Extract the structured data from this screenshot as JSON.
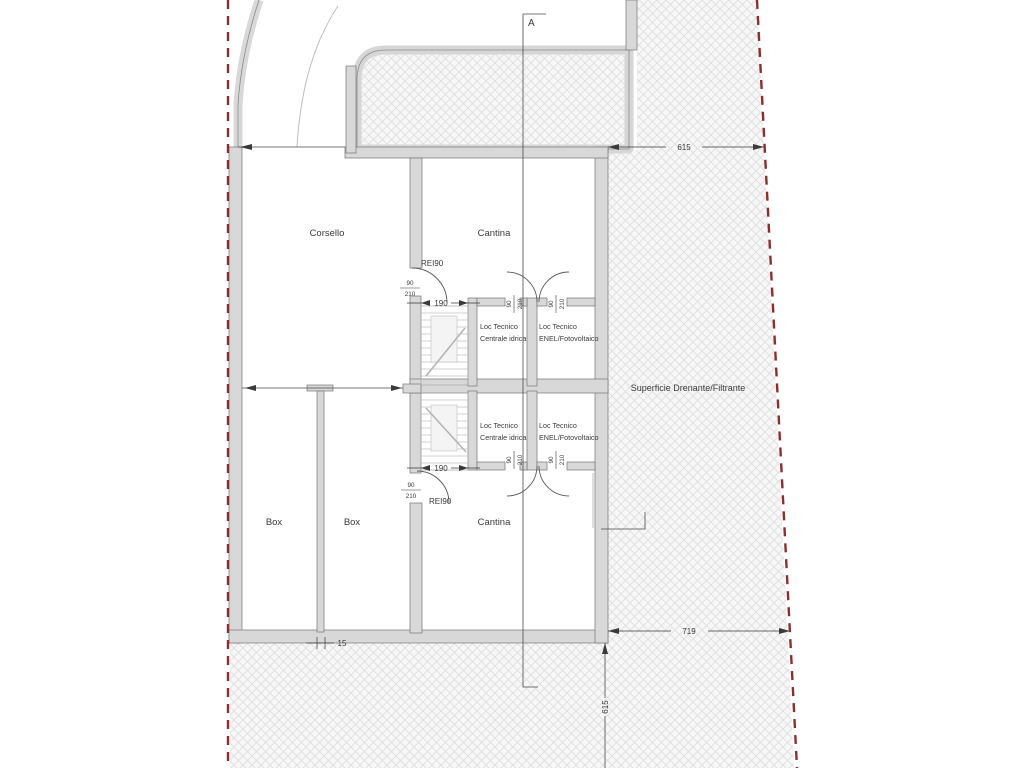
{
  "drawing": {
    "title_hint": "basement floor plan",
    "section_label": "A",
    "site_label": "Superficie Drenante/Filtrante",
    "rooms": {
      "corsello": "Corsello",
      "cantina_top": "Cantina",
      "cantina_bottom": "Cantina",
      "box_left": "Box",
      "box_right": "Box"
    },
    "tech": {
      "line1": "Loc Tecnico",
      "water": "Centrale idrica",
      "enel": "ENEL/Fotovoltaico"
    },
    "fire_rating": "REI90",
    "door_size": {
      "width": "90",
      "height": "210"
    },
    "dims": {
      "site_top": "615",
      "site_bottom": "719",
      "site_side": "615",
      "stair_top": "190",
      "stair_bottom": "190",
      "wall": "15"
    },
    "colors": {
      "boundary_red": "#8b2e2e",
      "wall_fill": "#d8d8d8",
      "hatch_line": "#dedede",
      "line_dark": "#3a3a3a"
    }
  }
}
